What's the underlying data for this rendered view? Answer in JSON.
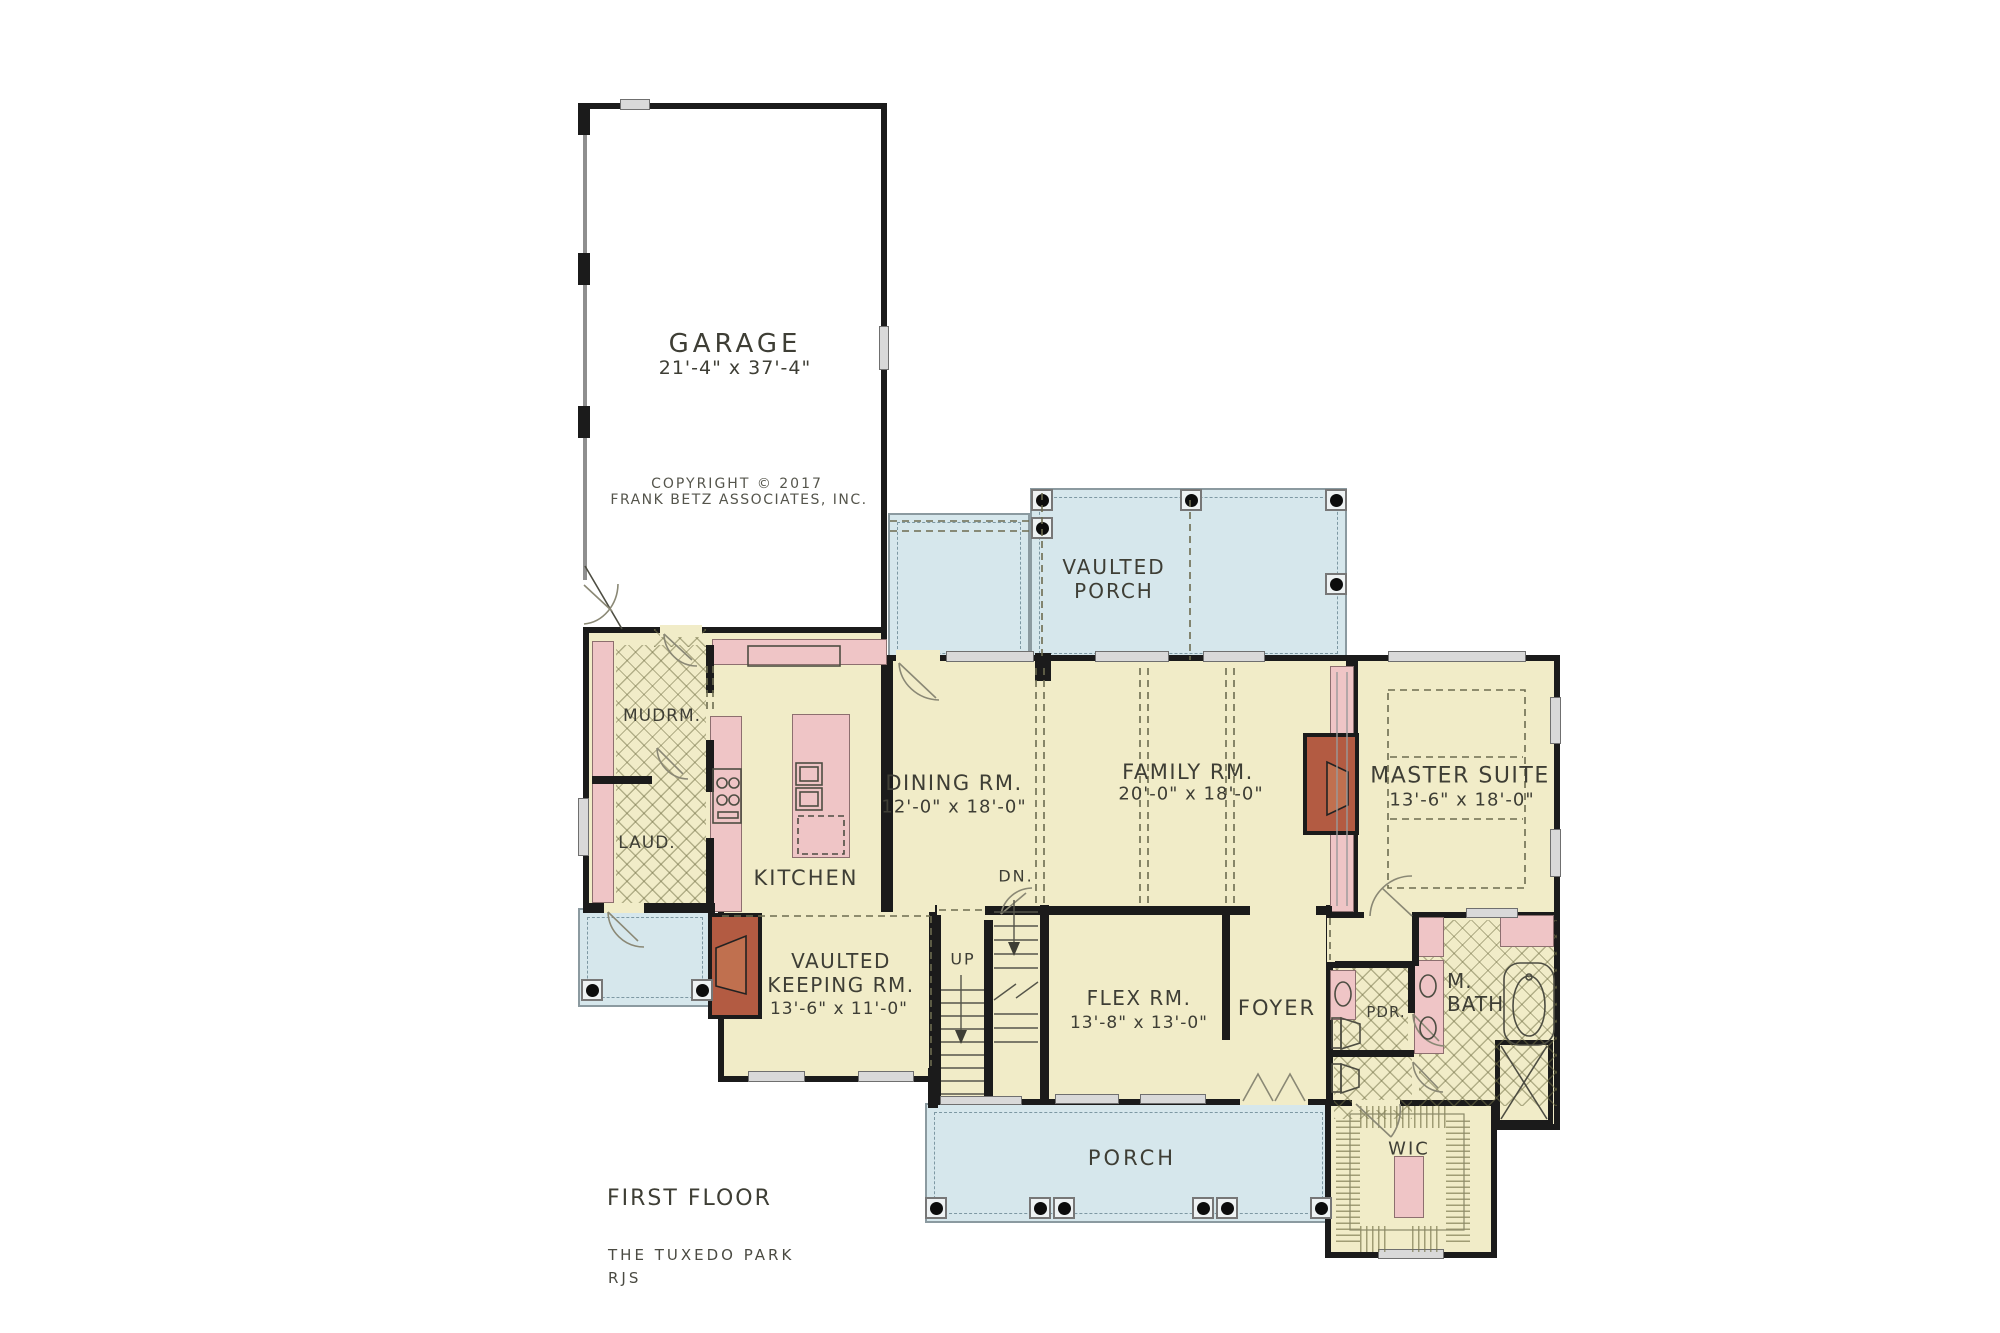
{
  "colors": {
    "floor": "#f1ecc8",
    "porch": "#d6e7ec",
    "wall": "#1b1b1b",
    "pink": "#efc5c6",
    "pinkfix": "#f0b9bc",
    "brick": "#b35b42",
    "firebox": "#c0704f",
    "ink": "#3e3e35",
    "dash": "#6d6c50",
    "winfill": "#d9d9d9"
  },
  "copyright": {
    "line1": "COPYRIGHT © 2017",
    "line2": "FRANK BETZ ASSOCIATES, INC."
  },
  "footer": {
    "floor_label": "FIRST FLOOR",
    "plan_name": "THE TUXEDO PARK",
    "initials": "RJS"
  },
  "rooms": {
    "garage": {
      "name": "GARAGE",
      "dims": "21'-4\" x 37'-4\""
    },
    "vaulted_porch": {
      "line1": "VAULTED",
      "line2": "PORCH"
    },
    "dining": {
      "name": "DINING RM.",
      "dims": "12'-0\" x 18'-0\""
    },
    "family": {
      "name": "FAMILY RM.",
      "dims": "20'-0\" x 18'-0\""
    },
    "master": {
      "name": "MASTER SUITE",
      "dims": "13'-6\" x 18'-0\""
    },
    "kitchen": {
      "name": "KITCHEN"
    },
    "mudroom": {
      "name": "MUDRM."
    },
    "laundry": {
      "name": "LAUD."
    },
    "keeping": {
      "line1": "VAULTED",
      "line2": "KEEPING RM.",
      "dims": "13'-6\" x 11'-0\""
    },
    "flex": {
      "name": "FLEX RM.",
      "dims": "13'-8\" x 13'-0\""
    },
    "foyer": {
      "name": "FOYER"
    },
    "powder": {
      "name": "PDR."
    },
    "master_bath": {
      "line1": "M.",
      "line2": "BATH"
    },
    "wic": {
      "name": "WIC"
    },
    "porch": {
      "name": "PORCH"
    }
  },
  "stairs": {
    "up_label": "UP",
    "down_label": "DN."
  }
}
